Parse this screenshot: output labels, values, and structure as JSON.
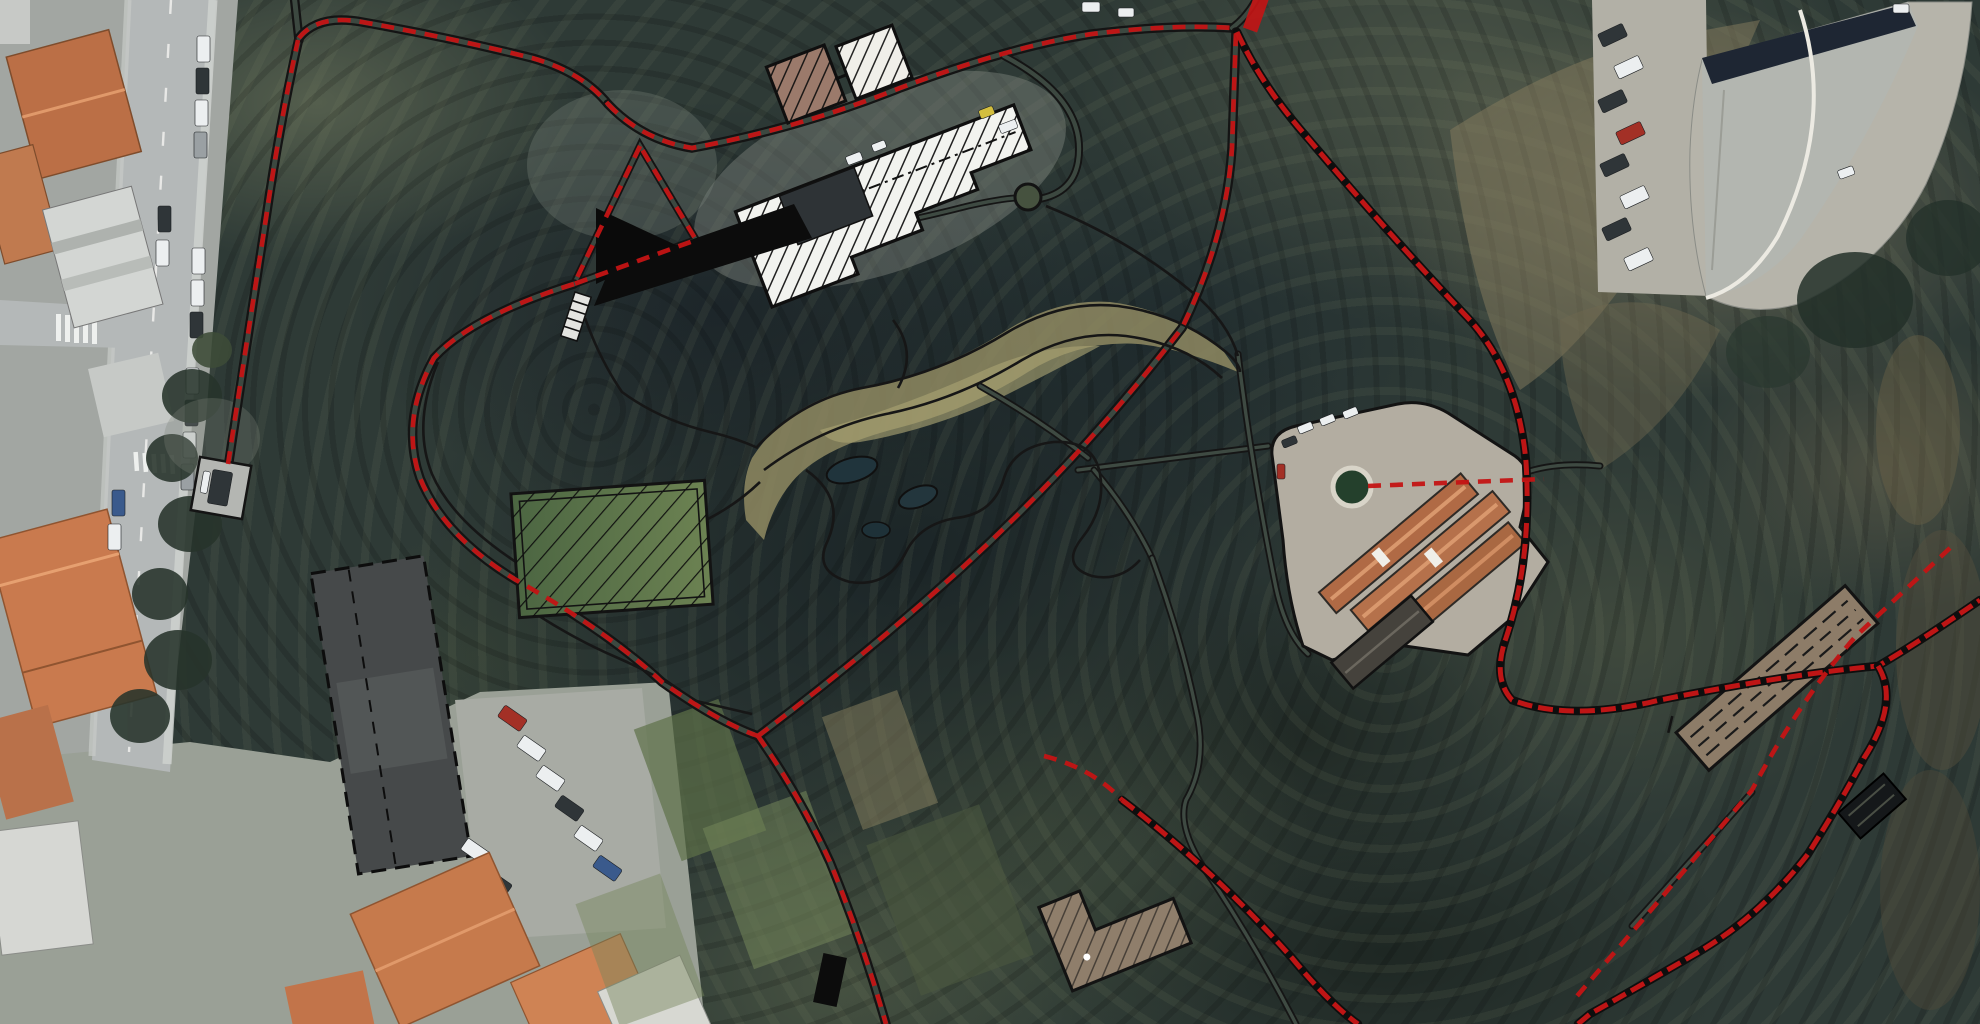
{
  "page": {
    "title": "Aerial site plan — park route overlay",
    "canvas": {
      "width": 1980,
      "height": 1024
    },
    "visible_text": []
  },
  "map": {
    "kind": "satellite-imagery-with-plan-overlay",
    "colors": {
      "route_red": "#c41414",
      "plan_outline_black": "#141414",
      "woodland_dark": "#2c3833",
      "woodland_sage": "#77815f",
      "slope_khaki": "#8d8568",
      "asphalt": "#b4b8b8",
      "roof_terracotta": "#c4764a",
      "roof_gray": "#b6b8b1",
      "field_green": "#57704a",
      "greenhouse_white": "#f2f3ef"
    },
    "overlay_semantics": {
      "red_dashed_line": "planned pedestrian route network",
      "double_black_line": "park path / road corridor edges",
      "solid_black_shapes": "planned structures (triangle platform, ramp wedge, bar)",
      "hatched_outlines": "building and facility footprints"
    },
    "features": [
      {
        "name": "city-street-strip",
        "kind": "urban road with parked cars",
        "approx_px": [
          0,
          0,
          235,
          800
        ]
      },
      {
        "name": "route-stub-parking",
        "kind": "small fenced stand with vehicle",
        "approx_px": [
          196,
          462,
          50,
          52
        ]
      },
      {
        "name": "black-triangle-structure",
        "approx_px": [
          594,
          205,
          84,
          80
        ]
      },
      {
        "name": "black-wedge-ramp",
        "approx_px": [
          594,
          204,
          218,
          104
        ]
      },
      {
        "name": "stairs-marking",
        "approx_px": [
          575,
          292,
          18,
          48
        ]
      },
      {
        "name": "hatched-square-buildings",
        "count": 2,
        "approx_px": [
          770,
          28,
          140,
          105
        ]
      },
      {
        "name": "greenhouse-terraced-white-hatched",
        "approx_px": [
          740,
          105,
          305,
          185
        ]
      },
      {
        "name": "cul-de-sac-loop",
        "approx_px": [
          1000,
          50,
          90,
          155
        ]
      },
      {
        "name": "green-hatched-field",
        "approx_px": [
          515,
          487,
          197,
          125
        ]
      },
      {
        "name": "pond-garden-paths",
        "approx_px": [
          745,
          300,
          500,
          290
        ]
      },
      {
        "name": "courtyard-complex-terracotta",
        "approx_px": [
          1265,
          400,
          285,
          255
        ]
      },
      {
        "name": "roundabout-circle",
        "approx_px": [
          1333,
          468,
          38,
          38
        ]
      },
      {
        "name": "crescent-building",
        "approx_px": [
          1690,
          0,
          290,
          310
        ]
      },
      {
        "name": "crescent-parking-lot",
        "approx_px": [
          1592,
          0,
          115,
          295
        ]
      },
      {
        "name": "long-terraced-building",
        "approx_px": [
          1665,
          575,
          210,
          200
        ]
      },
      {
        "name": "l-shaped-building",
        "approx_px": [
          1050,
          875,
          145,
          135
        ]
      },
      {
        "name": "small-black-hatched-structure",
        "approx_px": [
          1840,
          785,
          62,
          46
        ]
      },
      {
        "name": "black-bar-structure",
        "approx_px": [
          816,
          955,
          30,
          50
        ]
      },
      {
        "name": "school-building-dashed",
        "approx_px": [
          330,
          560,
          120,
          310
        ]
      },
      {
        "name": "lower-parking-lot",
        "approx_px": [
          455,
          688,
          210,
          250
        ]
      },
      {
        "name": "orange-roof-cluster",
        "approx_px": [
          290,
          850,
          370,
          174
        ]
      },
      {
        "name": "top-junction",
        "kind": "red route junction",
        "approx_px": [
          1232,
          28,
          1,
          1
        ]
      },
      {
        "name": "south-junction",
        "kind": "red route junction",
        "approx_px": [
          758,
          736,
          1,
          1
        ]
      }
    ]
  }
}
